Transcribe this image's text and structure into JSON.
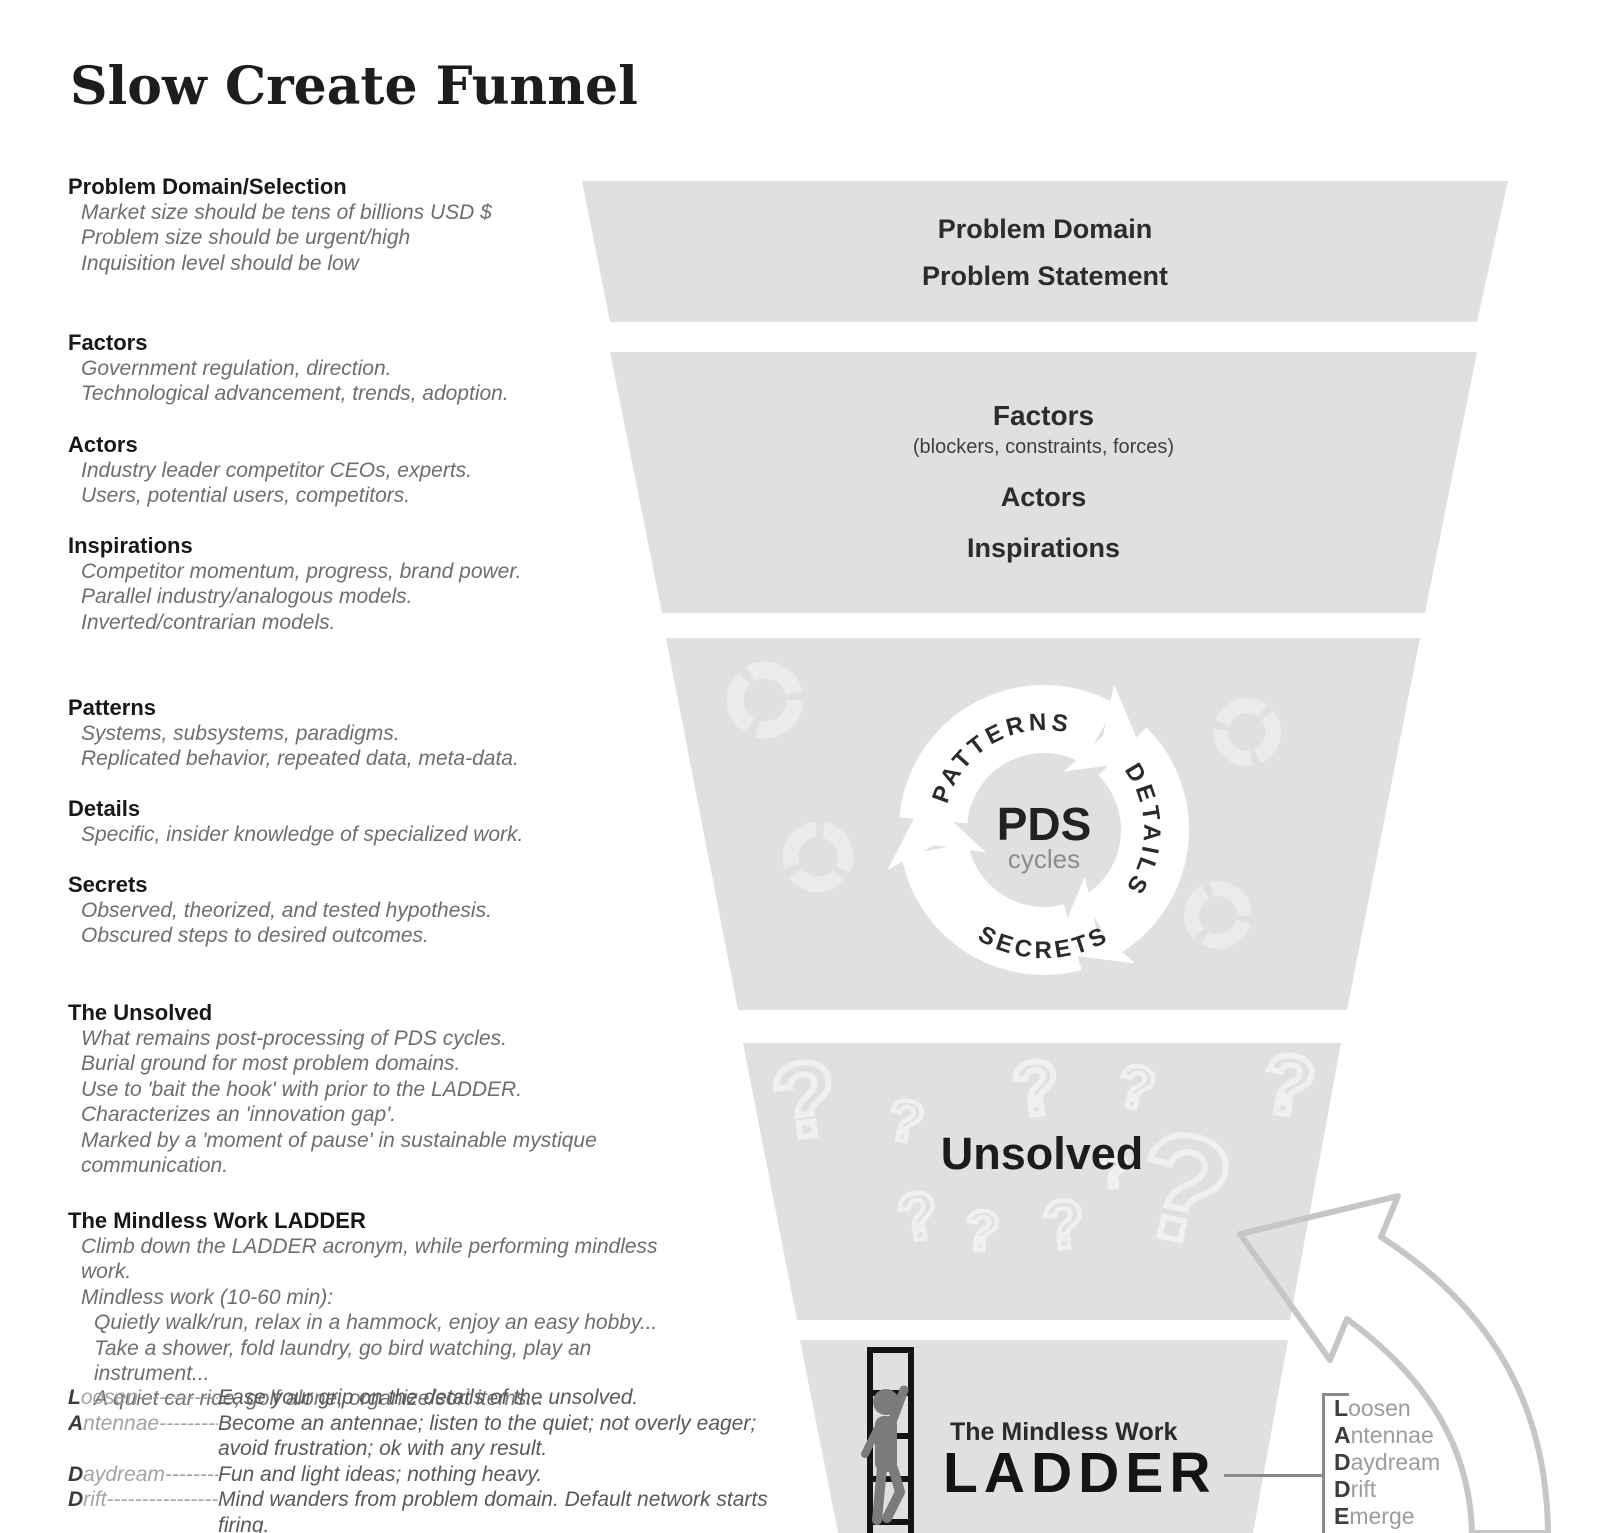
{
  "title": "Slow Create Funnel",
  "left": {
    "sections": [
      {
        "heading": "Problem Domain/Selection",
        "items": [
          "Market size should be tens of billions USD $",
          "Problem size should be urgent/high",
          "Inquisition level should be low"
        ]
      },
      {
        "heading": "Factors",
        "items": [
          "Government regulation, direction.",
          "Technological advancement, trends, adoption."
        ]
      },
      {
        "heading": "Actors",
        "items": [
          "Industry leader competitor CEOs, experts.",
          "Users, potential users, competitors."
        ]
      },
      {
        "heading": "Inspirations",
        "items": [
          "Competitor momentum, progress, brand power.",
          "Parallel industry/analogous models.",
          "Inverted/contrarian models."
        ]
      },
      {
        "heading": "Patterns",
        "items": [
          "Systems, subsystems, paradigms.",
          "Replicated behavior, repeated data, meta-data."
        ]
      },
      {
        "heading": "Details",
        "items": [
          "Specific, insider knowledge of specialized work."
        ]
      },
      {
        "heading": "Secrets",
        "items": [
          "Observed, theorized, and tested hypothesis.",
          "Obscured steps to desired outcomes."
        ]
      },
      {
        "heading": "The Unsolved",
        "items": [
          "What remains post-processing of PDS cycles.",
          "Burial ground for most problem domains.",
          "Use to 'bait the hook' with prior to the LADDER.",
          "Characterizes an 'innovation gap'.",
          "Marked by a 'moment of pause' in sustainable mystique communication."
        ]
      },
      {
        "heading": "The Mindless Work LADDER",
        "items": [
          "Climb down the LADDER acronym, while performing mindless work.",
          "Mindless work (10-60 min):"
        ],
        "subitems": [
          "Quietly walk/run, relax in a hammock, enjoy an easy hobby...",
          "Take a shower, fold laundry, go bird watching, play an instrument...",
          "A quiet car ride, golf alone, organize/sort items..."
        ]
      }
    ],
    "acronym": [
      {
        "letter": "L",
        "rest": "oosen",
        "dashes": "--------------------",
        "desc": "Ease your grip on the details of the unsolved."
      },
      {
        "letter": "A",
        "rest": "ntennae",
        "dashes": "----------------",
        "desc": "Become an antennae; listen to the quiet; not overly eager; avoid frustration; ok with any result."
      },
      {
        "letter": "D",
        "rest": "aydream",
        "dashes": "---------------",
        "desc": "Fun and light ideas; nothing heavy."
      },
      {
        "letter": "D",
        "rest": "rift",
        "dashes": "----------------------",
        "desc": "Mind wanders from problem domain. Default network starts firing."
      }
    ]
  },
  "funnel": {
    "s1": {
      "line1": "Problem Domain",
      "line2": "Problem Statement"
    },
    "s2": {
      "heading": "Factors",
      "sub": "(blockers, constraints, forces)",
      "line2": "Actors",
      "line3": "Inspirations"
    },
    "s3": {
      "label_top": "PATTERNS",
      "label_right": "DETAILS",
      "label_bottom": "SECRETS",
      "center": "PDS",
      "center_sub": "cycles"
    },
    "s4": {
      "label": "Unsolved",
      "qmark": "?"
    },
    "s5": {
      "line1": "The Mindless Work",
      "line2": "LADDER",
      "list": [
        {
          "letter": "L",
          "rest": "oosen"
        },
        {
          "letter": "A",
          "rest": "ntennae"
        },
        {
          "letter": "D",
          "rest": "aydream"
        },
        {
          "letter": "D",
          "rest": "rift"
        },
        {
          "letter": "E",
          "rest": "merge"
        }
      ]
    }
  },
  "colors": {
    "funnel_fill": "#e0e0e0",
    "arrow_outline": "#c6c6c6",
    "faint_icon": "#ebebeb",
    "line_gray": "#8a8a8a"
  }
}
